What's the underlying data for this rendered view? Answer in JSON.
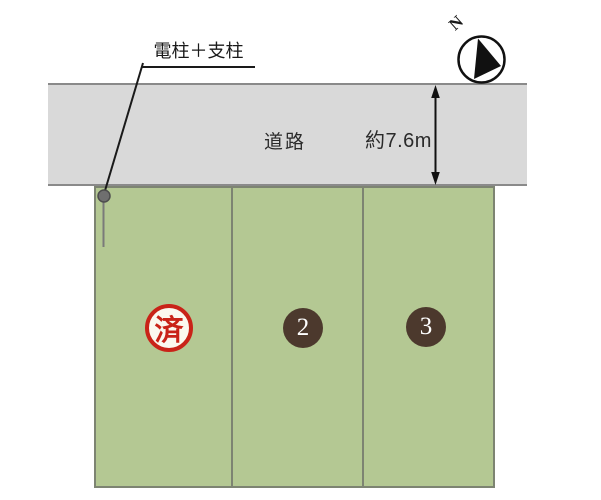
{
  "canvas": {
    "width": 601,
    "height": 500,
    "background": "#ffffff"
  },
  "compass": {
    "label": "N"
  },
  "road": {
    "label": "道路",
    "width_label": "約7.6m"
  },
  "pole": {
    "label": "電柱＋支柱"
  },
  "lots": [
    {
      "name": "lot-1",
      "marker": "済",
      "marker_type": "sold-stamp"
    },
    {
      "name": "lot-2",
      "marker": "2",
      "marker_type": "number-badge"
    },
    {
      "name": "lot-3",
      "marker": "3",
      "marker_type": "number-badge"
    }
  ],
  "colors": {
    "road_fill": "#d9d9d9",
    "road_border": "#8a8a8a",
    "lot_fill": "#b4c893",
    "lot_border": "#7d8472",
    "sold_red": "#c92318",
    "number_circle_brown": "#4c392d",
    "annotation_line": "#1a1a1a",
    "pole_gray": "#6f6f6f"
  }
}
